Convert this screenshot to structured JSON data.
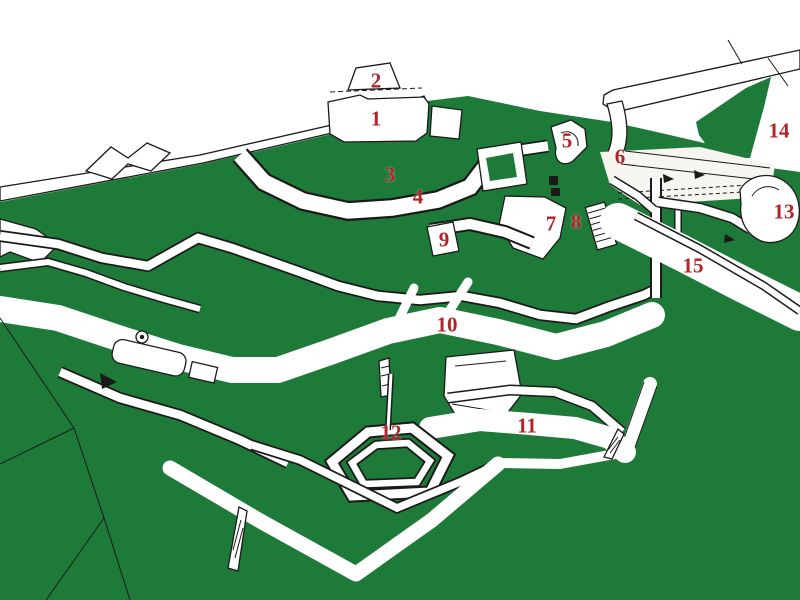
{
  "map": {
    "colors": {
      "terrain_green": "#1e7a38",
      "paper": "#ffffff",
      "walls": "#ffffff",
      "ink": "#1a1a1a",
      "label_red": "#b22427"
    },
    "markers": [
      {
        "label": "1",
        "x": 376,
        "y": 119
      },
      {
        "label": "2",
        "x": 376,
        "y": 81
      },
      {
        "label": "3",
        "x": 390,
        "y": 175
      },
      {
        "label": "4",
        "x": 418,
        "y": 197
      },
      {
        "label": "5",
        "x": 567,
        "y": 141
      },
      {
        "label": "6",
        "x": 620,
        "y": 157
      },
      {
        "label": "7",
        "x": 551,
        "y": 224
      },
      {
        "label": "8",
        "x": 576,
        "y": 222
      },
      {
        "label": "9",
        "x": 444,
        "y": 240
      },
      {
        "label": "10",
        "x": 447,
        "y": 325
      },
      {
        "label": "11",
        "x": 527,
        "y": 426
      },
      {
        "label": "12",
        "x": 391,
        "y": 433
      },
      {
        "label": "13",
        "x": 784,
        "y": 212
      },
      {
        "label": "14",
        "x": 779,
        "y": 131
      },
      {
        "label": "15",
        "x": 693,
        "y": 266
      }
    ]
  }
}
